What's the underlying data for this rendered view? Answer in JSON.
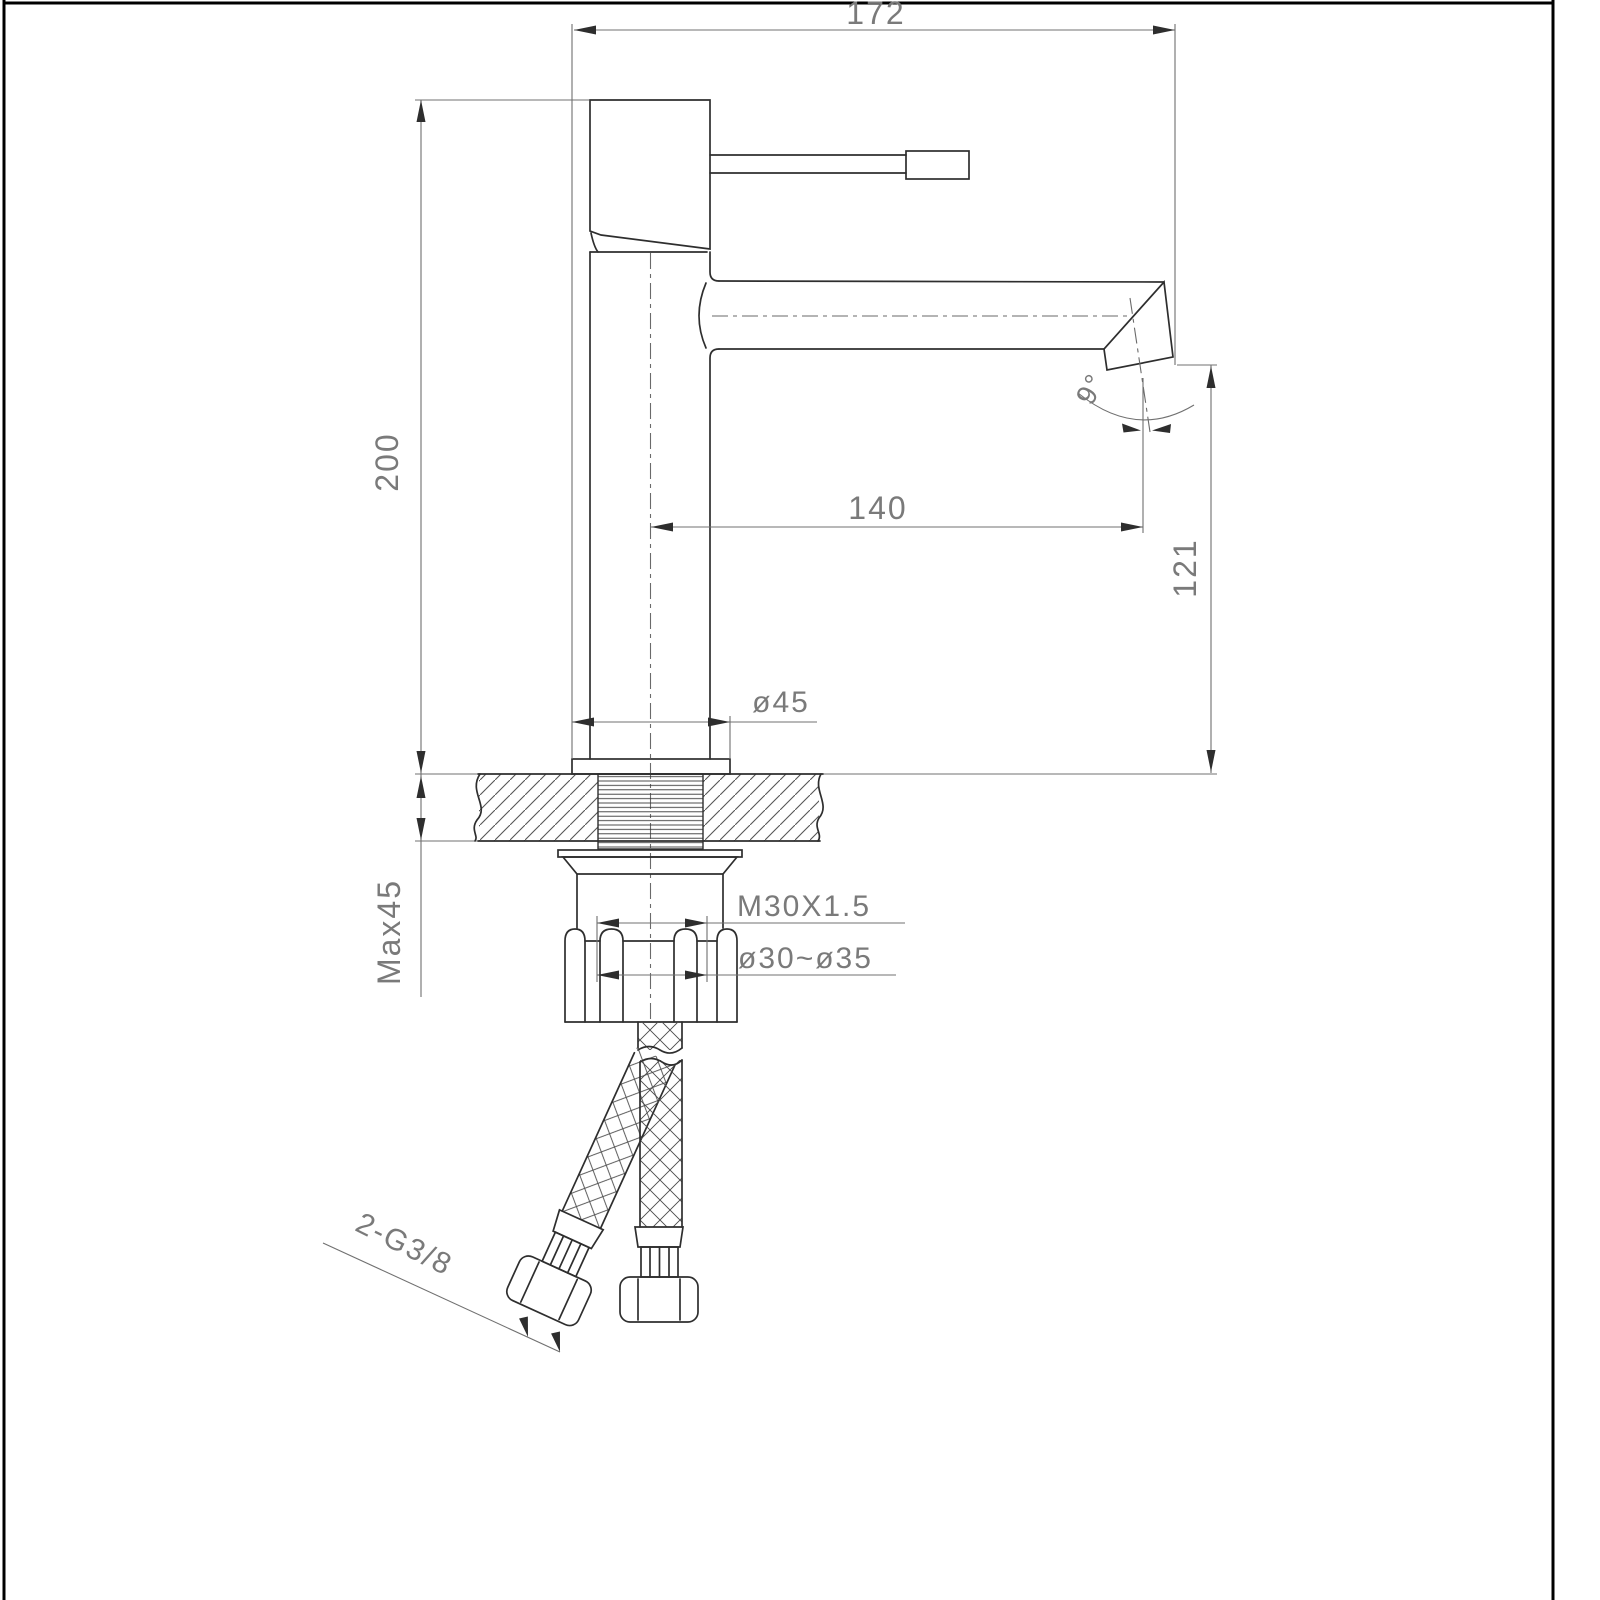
{
  "drawing": {
    "title_hint": "faucet-installation-dimension-drawing",
    "colors": {
      "background": "#ffffff",
      "object_line": "#2e2e2e",
      "dimension_line": "#707070",
      "text": "#7a7a7a",
      "sheet_border": "#000000"
    },
    "labels": {
      "overall_width": "172",
      "total_height": "200",
      "spout_reach": "140",
      "outlet_height": "121",
      "outlet_angle": "9°",
      "base_diameter": "ø45",
      "max_mount_thickness": "Max45",
      "thread_size": "M30X1.5",
      "hole_diameter_range": "ø30~ø35",
      "hose_connection": "2-G3/8"
    }
  }
}
